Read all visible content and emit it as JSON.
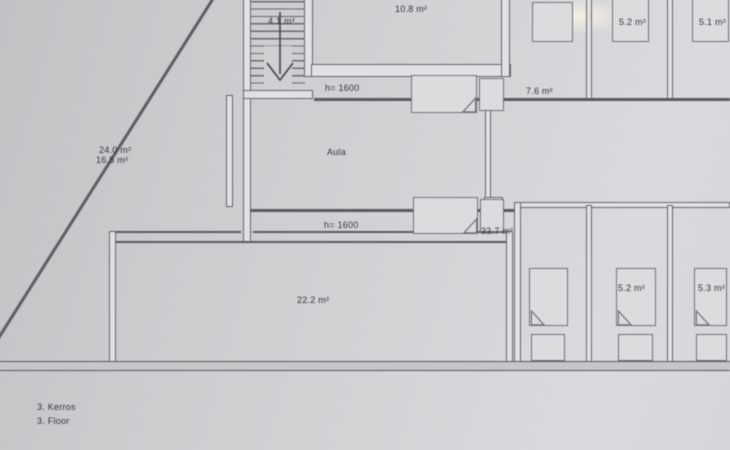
{
  "plan": {
    "floor_label_fi": "3. Kerros",
    "floor_label_en": "3. Floor",
    "labels": {
      "staircase_area": "4.1 m²",
      "top_room_area": "10.8 m²",
      "top_right_room2_area": "5.2 m²",
      "top_right_room3_area": "5.1 m²",
      "height_line_top": "h= 1600",
      "front_room_area": "7.6 m²",
      "left_slope_area_gross": "24.0 m²",
      "left_slope_area_net": "16.5 m²",
      "hall_name": "Aula",
      "height_line_bottom": "h= 1600",
      "hall_area": "33.7 m²",
      "large_room_area": "22.2 m²",
      "bottom_right_room2_area": "5.2 m²",
      "bottom_right_room3_area": "5.3 m²"
    },
    "colors": {
      "paper": "#d2d2d4",
      "line": "#5d5d62",
      "text": "#36363b",
      "wall_fill": "#e1e1e4"
    }
  }
}
